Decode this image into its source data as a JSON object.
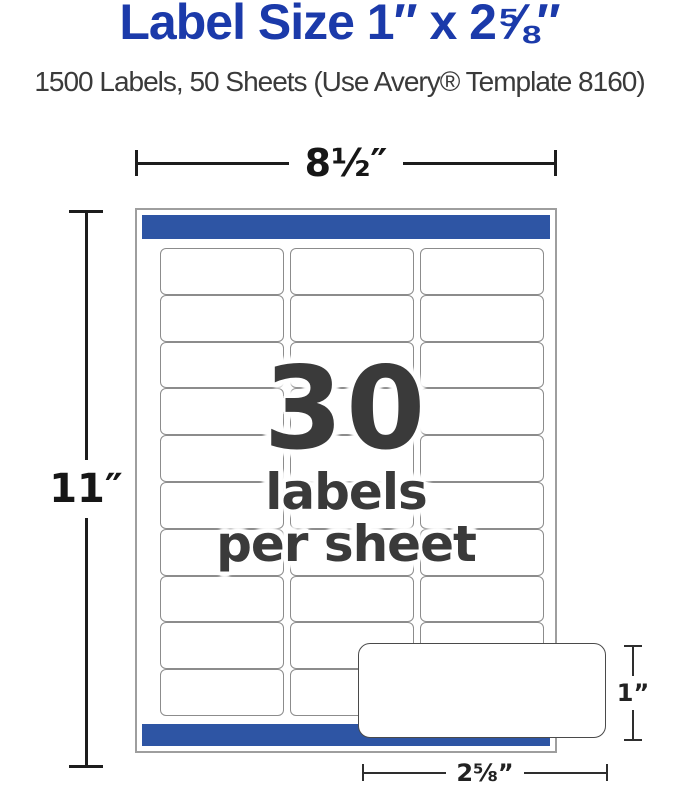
{
  "header": {
    "title": "Label Size 1″ x 2⅝″",
    "subtitle": "1500 Labels, 50 Sheets (Use Avery® Template 8160)"
  },
  "diagram": {
    "sheet_width_label": "8½″",
    "sheet_height_label": "11″",
    "grid": {
      "rows": 10,
      "columns": 3
    },
    "caption": {
      "count": "30",
      "line1": "labels",
      "line2": "per sheet"
    },
    "callout": {
      "height_label": "1”",
      "width_label": "2⅝”"
    }
  },
  "colors": {
    "title_blue": "#1b3aaa",
    "bar_blue": "#2e55a4",
    "caption_gray": "#3a3a3a",
    "dimension_line": "#1d1d1d",
    "label_border": "#8c8c8c",
    "sheet_border": "#9e9e9e"
  }
}
